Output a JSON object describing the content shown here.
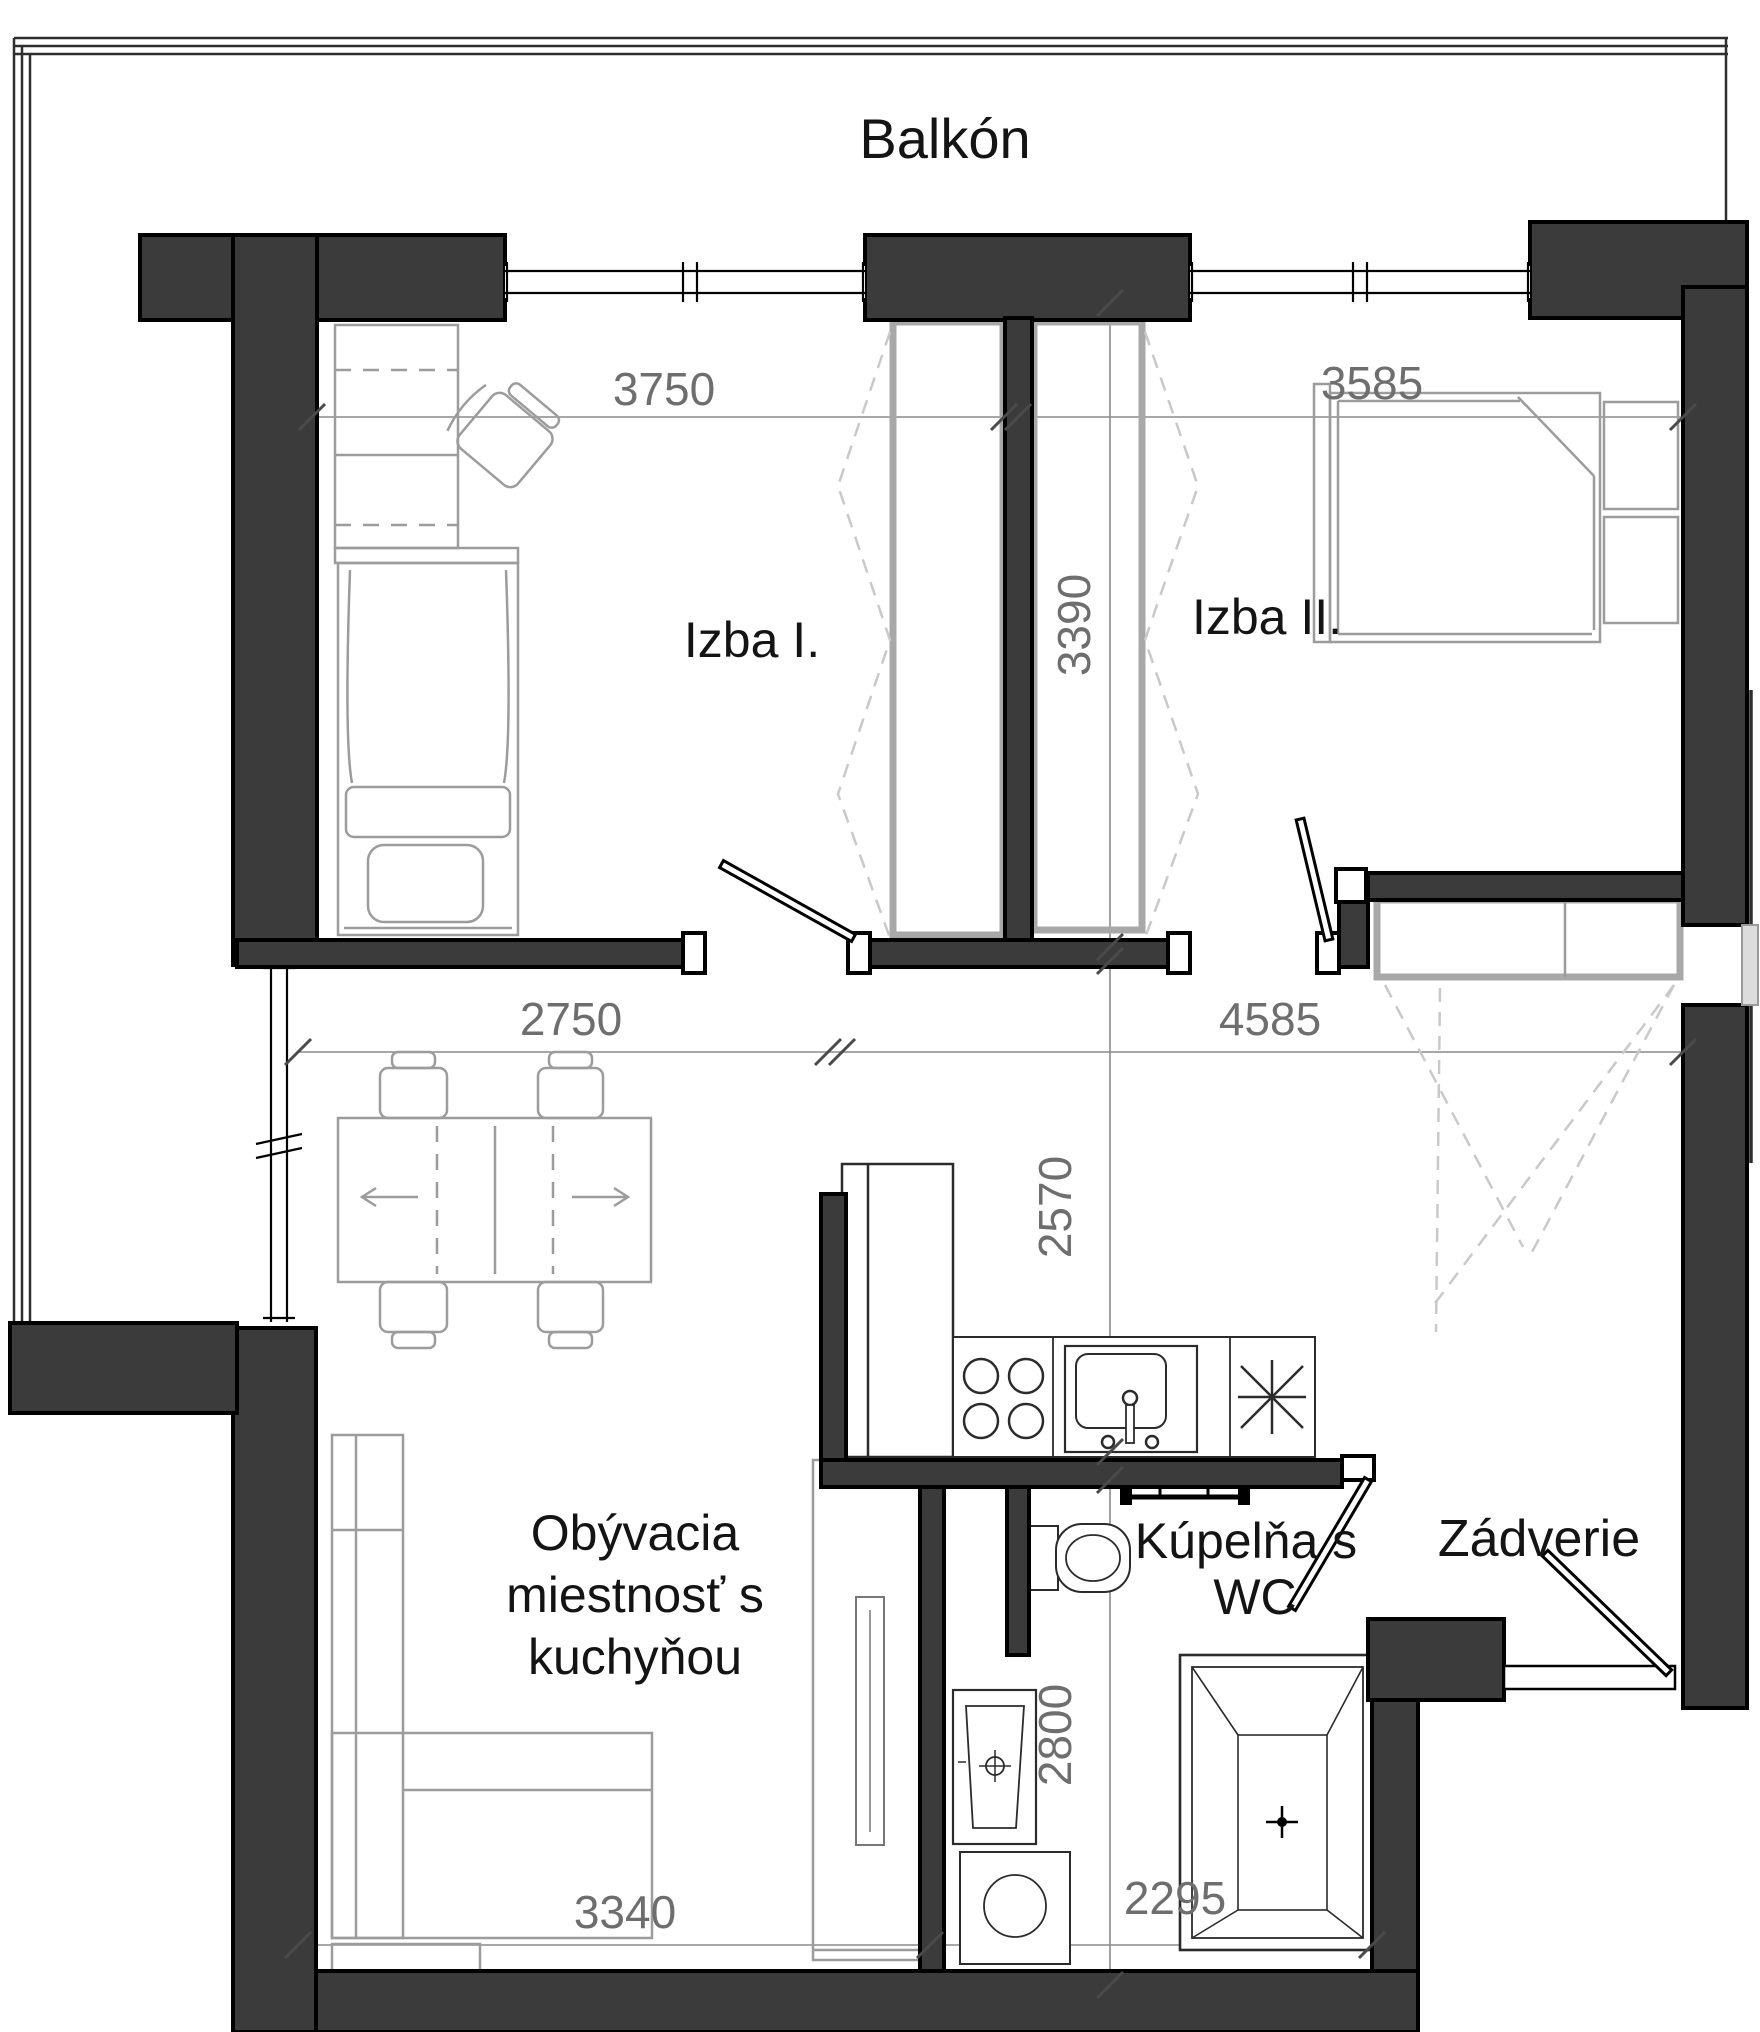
{
  "document_type": "apartment floor plan",
  "rooms": [
    {
      "name": "balcony",
      "label": "Balkón"
    },
    {
      "name": "room-1",
      "label": "Izba I."
    },
    {
      "name": "room-2",
      "label": "Izba II."
    },
    {
      "name": "living-room-with-kitchen",
      "label_lines": [
        "Obývacia",
        "miestnosť s",
        "kuchyňou"
      ]
    },
    {
      "name": "bathroom-with-wc",
      "label_lines": [
        "Kúpelňa s",
        "WC"
      ]
    },
    {
      "name": "entry-hall",
      "label": "Zádverie"
    }
  ],
  "dimensions_mm": {
    "room1_width": "3750",
    "room2_width": "3585",
    "wardrobe_wall_depth": "3390",
    "living_window_width": "2750",
    "hall_span_width": "4585",
    "kitchen_depth": "2570",
    "bathroom_depth": "2800",
    "living_bottom_width": "3340",
    "bathroom_bottom_width": "2295"
  },
  "colors": {
    "wall_fill": "#3b3b3b",
    "wall_stroke": "#000000",
    "dimension_text": "#6e6e6e",
    "furniture_outline": "#9c9c9c",
    "wardrobe_outline": "#a8a8a8",
    "dashed_swing": "#c9c9c9",
    "label_text": "#141414",
    "background": "#ffffff"
  }
}
